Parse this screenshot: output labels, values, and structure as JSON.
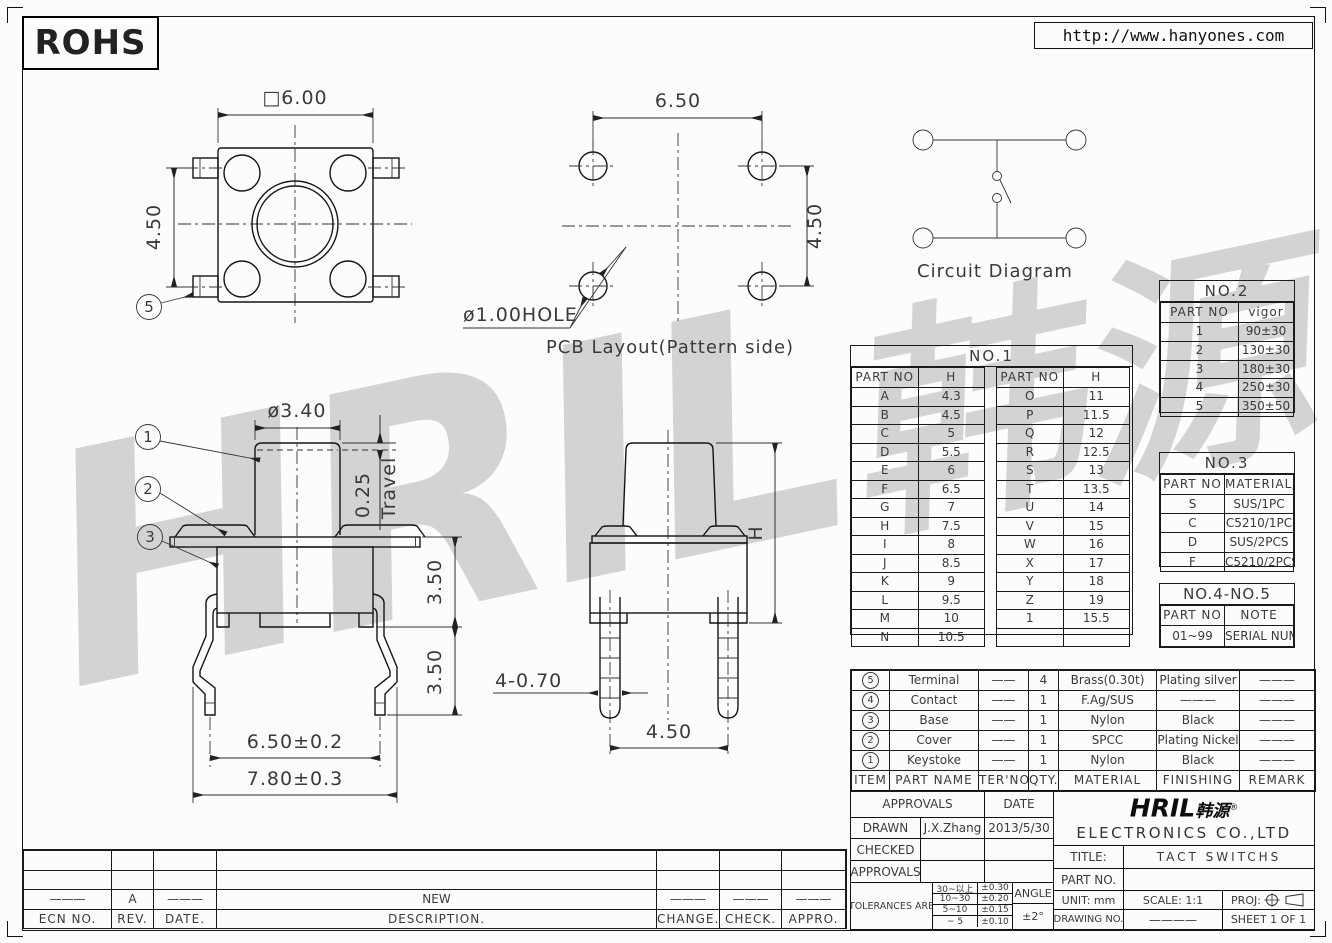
{
  "sheet": {
    "rohs": "ROHS",
    "url": "http://www.hanyones.com",
    "watermark_latin": "HRIL",
    "watermark_cn": "韩源"
  },
  "views": {
    "top": {
      "w": "□6.00",
      "h": "4.50",
      "callout5": "5"
    },
    "pcb": {
      "w": "6.50",
      "h": "4.50",
      "hole": "ø1.00HOLE",
      "caption": "PCB Layout(Pattern side)"
    },
    "circuit": {
      "caption": "Circuit Diagram"
    },
    "side": {
      "cap": "ø3.40",
      "travel_val": "0.25",
      "travel": "Travel",
      "body": "3.50",
      "leg": "3.50",
      "pins": "6.50±0.2",
      "overall": "7.80±0.3",
      "c1": "1",
      "c2": "2",
      "c3": "3"
    },
    "front": {
      "h": "H",
      "pin": "4-0.70",
      "pitch": "4.50"
    }
  },
  "no1": {
    "title": "NO.1",
    "part": "PART NO",
    "h": "H",
    "left": [
      [
        "A",
        "4.3"
      ],
      [
        "B",
        "4.5"
      ],
      [
        "C",
        "5"
      ],
      [
        "D",
        "5.5"
      ],
      [
        "E",
        "6"
      ],
      [
        "F",
        "6.5"
      ],
      [
        "G",
        "7"
      ],
      [
        "H",
        "7.5"
      ],
      [
        "I",
        "8"
      ],
      [
        "J",
        "8.5"
      ],
      [
        "K",
        "9"
      ],
      [
        "L",
        "9.5"
      ],
      [
        "M",
        "10"
      ],
      [
        "N",
        "10.5"
      ]
    ],
    "right": [
      [
        "O",
        "11"
      ],
      [
        "P",
        "11.5"
      ],
      [
        "Q",
        "12"
      ],
      [
        "R",
        "12.5"
      ],
      [
        "S",
        "13"
      ],
      [
        "T",
        "13.5"
      ],
      [
        "U",
        "14"
      ],
      [
        "V",
        "15"
      ],
      [
        "W",
        "16"
      ],
      [
        "X",
        "17"
      ],
      [
        "Y",
        "18"
      ],
      [
        "Z",
        "19"
      ],
      [
        "1",
        "15.5"
      ],
      [
        "",
        ""
      ]
    ]
  },
  "no2": {
    "title": "NO.2",
    "part": "PART NO",
    "val": "vigor",
    "rows": [
      [
        "1",
        "90±30"
      ],
      [
        "2",
        "130±30"
      ],
      [
        "3",
        "180±30"
      ],
      [
        "4",
        "250±30"
      ],
      [
        "5",
        "350±50"
      ]
    ]
  },
  "no3": {
    "title": "NO.3",
    "part": "PART NO",
    "val": "MATERIAL/QTY",
    "rows": [
      [
        "S",
        "SUS/1PC"
      ],
      [
        "C",
        "C5210/1PC"
      ],
      [
        "D",
        "SUS/2PCS"
      ],
      [
        "F",
        "C5210/2PCS"
      ]
    ]
  },
  "no45": {
    "title": "NO.4-NO.5",
    "part": "PART NO",
    "val": "NOTE",
    "rows": [
      [
        "01~99",
        "SERIAL NUMBER"
      ]
    ]
  },
  "bom": {
    "headers": [
      "ITEM",
      "PART NAME",
      "TER'NO.",
      "QTY.",
      "MATERIAL",
      "FINISHING",
      "REMARK"
    ],
    "rows": [
      [
        "5",
        "Terminal",
        "——",
        "4",
        "Brass(0.30t)",
        "Plating silver",
        "———"
      ],
      [
        "4",
        "Contact",
        "——",
        "1",
        "F.Ag/SUS",
        "———",
        "———"
      ],
      [
        "3",
        "Base",
        "——",
        "1",
        "Nylon",
        "Black",
        "———"
      ],
      [
        "2",
        "Cover",
        "——",
        "1",
        "SPCC",
        "Plating Nickel",
        "———"
      ],
      [
        "1",
        "Keystoke",
        "——",
        "1",
        "Nylon",
        "Black",
        "———"
      ]
    ]
  },
  "rev": {
    "headers": [
      "ECN NO.",
      "REV.",
      "DATE.",
      "DESCRIPTION.",
      "CHANGE.",
      "CHECK.",
      "APPRO."
    ],
    "row_a": [
      "———",
      "A",
      "———",
      "NEW",
      "———",
      "———",
      "———"
    ]
  },
  "tb": {
    "approvals": "APPROVALS",
    "date": "DATE",
    "drawn": "DRAWN",
    "drawn_by": "J.X.Zhang",
    "drawn_date": "2013/5/30",
    "checked": "CHECKED",
    "approvals2": "APPROVALS",
    "tol": "TOLERANCES ARE",
    "tol_rows": [
      [
        "30~以上",
        "±0.30"
      ],
      [
        "10~30",
        "±0.20"
      ],
      [
        "5~10",
        "±0.15"
      ],
      [
        "~ 5",
        "±0.10"
      ]
    ],
    "angle": "ANGLE",
    "angle_val": "±2°",
    "logo": "HRIL",
    "logo_cn": "韩源",
    "reg": "®",
    "company": "ELECTRONICS CO.,LTD",
    "title_label": "TITLE:",
    "title": "TACT SWITCHS",
    "part_label": "PART NO.",
    "unit": "UNIT: mm",
    "scale": "SCALE: 1:1",
    "proj": "PROJ:",
    "drawing_no": "DRAWING NO.",
    "dash": "————",
    "sheet": "SHEET 1 OF 1"
  }
}
